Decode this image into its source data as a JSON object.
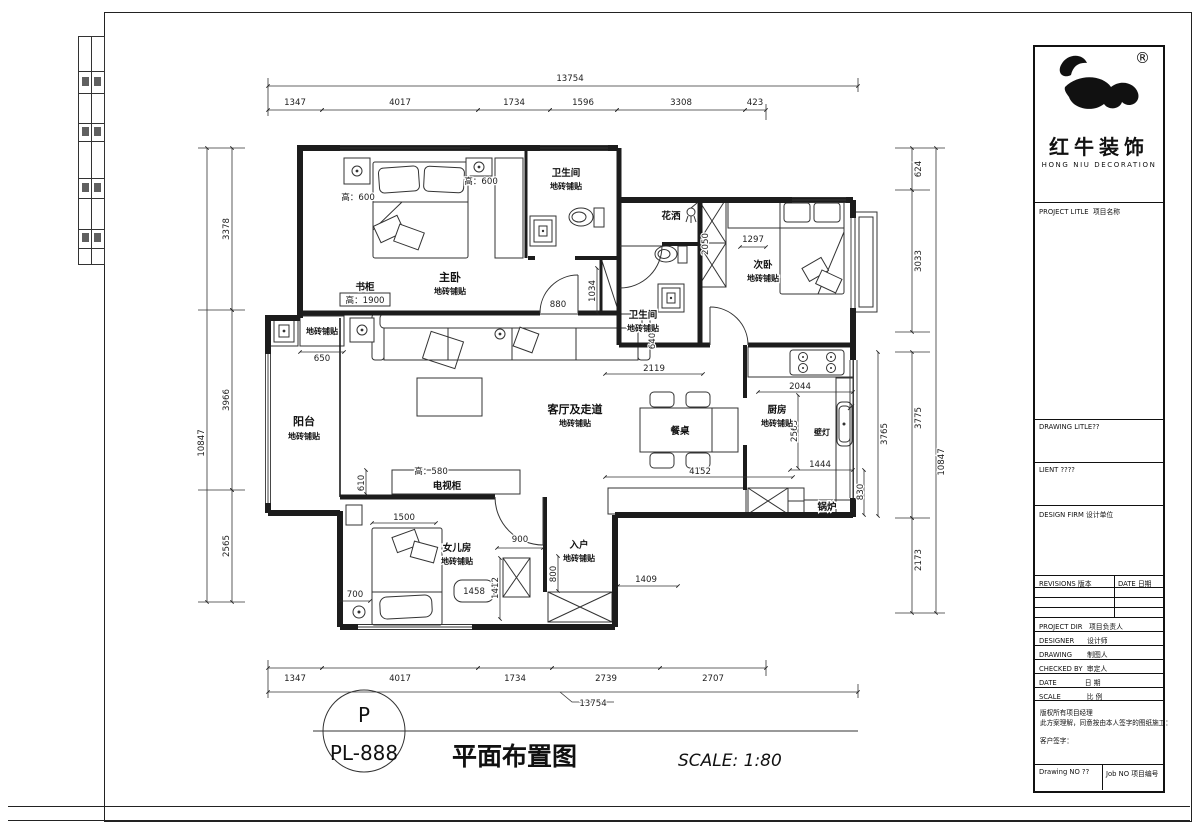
{
  "logo": {
    "registered": "®",
    "brand": "红牛装饰",
    "brand_en": "HONG NIU DECORATION"
  },
  "titleblock": {
    "project_title": "PROJECT LITLE  项目名称",
    "drawing_title": "DRAWING LITLE??",
    "client": "LIENT ????",
    "design_firm": "DESIGN FIRM 设计单位",
    "revisions": "REVISIONS 版本",
    "rev_date": "DATE 日期",
    "project_dir": "PROJECT DIR   项目负责人",
    "designer": "DESIGNER      设计师",
    "drawing": "DRAWING       制图人",
    "checked_by": "CHECKED BY  审定人",
    "date": "DATE             日 期",
    "scale": "SCALE            比 例",
    "note_line1": "版权所有项目经理",
    "note_line2": "此方案理解，同意按由本人签字的图纸施工：",
    "note_line3": "客户签字：",
    "drawing_no": "Drawing NO ??",
    "job_no": "Job NO 项目编号"
  },
  "footer": {
    "marker_top": "P",
    "marker_no": "PL-888",
    "title": "平面布置图",
    "scale": "SCALE: 1:80"
  },
  "plan": {
    "rooms": {
      "master": "主卧",
      "master_sub": "地砖铺贴",
      "bath1": "卫生间",
      "bath1_sub": "地砖铺贴",
      "shower": "花洒",
      "second": "次卧",
      "second_sub": "地砖铺贴",
      "bath2": "卫生间",
      "bath2_sub": "地砖铺贴",
      "balcony": "阳台",
      "balcony_sub": "地砖铺贴",
      "living": "客厅及走道",
      "living_sub": "地砖铺贴",
      "dining_table": "餐桌",
      "kitchen": "厨房",
      "kitchen_sub": "地砖铺贴",
      "wall_lamp": "壁灯",
      "boiler": "锅炉",
      "tv_cabinet": "电视柜",
      "girl": "女儿房",
      "girl_sub": "地砖铺贴",
      "entry": "入户",
      "entry_sub": "地砖铺贴",
      "balcony_cabinet": "地砖铺贴",
      "bookcase": "书柜",
      "bookcase_h": "高：1900",
      "h600a": "高：600",
      "h600b": "高：600",
      "h580": "高：580"
    },
    "dims": {
      "top_total": "13754",
      "top": [
        "1347",
        "4017",
        "1734",
        "1596",
        "3308",
        "423"
      ],
      "bottom": [
        "1347",
        "4017",
        "1734",
        "2739",
        "2707"
      ],
      "bottom_total": "13754",
      "left": [
        "3378",
        "3966",
        "2565"
      ],
      "left_total": "10847",
      "right": [
        "624",
        "3033",
        "3775",
        "2173"
      ],
      "right_total": "10847",
      "inner": {
        "d880": "880",
        "d650": "650",
        "d1034": "1034",
        "d2050": "2050",
        "d1297": "1297",
        "d640": "640",
        "d2119": "2119",
        "d2044": "2044",
        "d2565": "2565",
        "d1444": "1444",
        "d830": "830",
        "d4152": "4152",
        "d3765": "3765",
        "d610": "610",
        "d1500": "1500",
        "d900": "900",
        "d700": "700",
        "d1458": "1458",
        "d1412": "1412",
        "d800": "800",
        "d1409": "1409"
      }
    }
  }
}
